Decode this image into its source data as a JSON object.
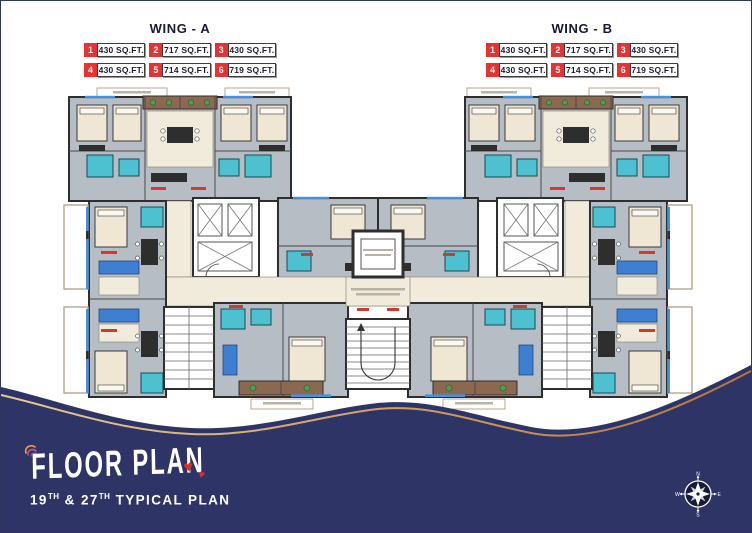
{
  "legend": {
    "wings": [
      {
        "title": "WING - A",
        "units": [
          {
            "no": "1",
            "area": "430 SQ.FT."
          },
          {
            "no": "2",
            "area": "717 SQ.FT."
          },
          {
            "no": "3",
            "area": "430 SQ.FT."
          },
          {
            "no": "4",
            "area": "430 SQ.FT."
          },
          {
            "no": "5",
            "area": "714 SQ.FT."
          },
          {
            "no": "6",
            "area": "719 SQ.FT."
          }
        ]
      },
      {
        "title": "WING - B",
        "units": [
          {
            "no": "1",
            "area": "430 SQ.FT."
          },
          {
            "no": "2",
            "area": "717 SQ.FT."
          },
          {
            "no": "3",
            "area": "430 SQ.FT."
          },
          {
            "no": "4",
            "area": "430 SQ.FT."
          },
          {
            "no": "5",
            "area": "714 SQ.FT."
          },
          {
            "no": "6",
            "area": "719 SQ.FT."
          }
        ]
      }
    ]
  },
  "footer": {
    "title": "FLOOR PLAN",
    "subtitle": {
      "p1": "19",
      "s1": "TH",
      "p2": " & 27",
      "s2": "TH",
      "p3": " TYPICAL PLAN"
    },
    "hearts": "♥",
    "compass": {
      "n": "N",
      "e": "E",
      "s": "S",
      "w": "W"
    }
  },
  "colors": {
    "navy": "#2e3465",
    "badge_red": "#e73231",
    "wave_gold_light": "#e5c98b",
    "wave_gold_dark": "#b5793f",
    "plan_gray": "#b7bdc5",
    "plan_teal": "#4ec1d1",
    "plan_cream": "#f1ebdc",
    "plan_brown": "#8d6850",
    "window_blue": "#4a90d9",
    "accent_red": "#d23a30",
    "heart_red": "#d93025"
  }
}
